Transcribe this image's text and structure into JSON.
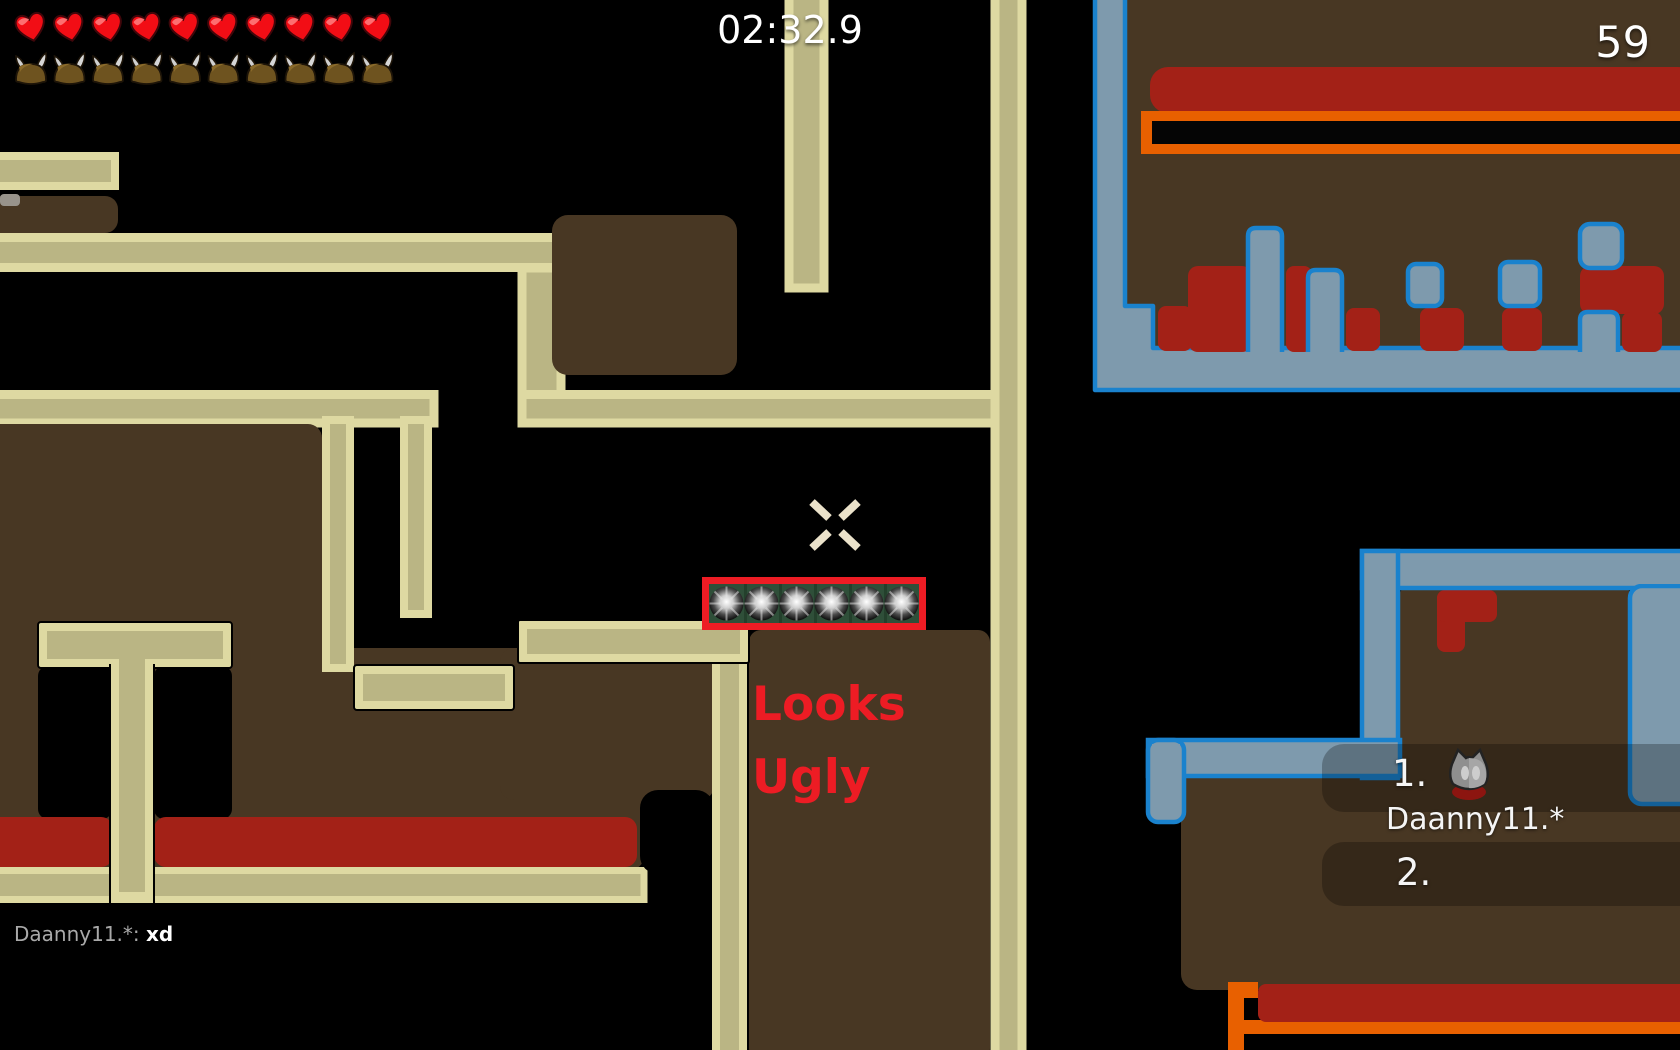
{
  "hud": {
    "timer": "02:32.9",
    "score": "59",
    "hearts": 10,
    "armors": 10
  },
  "chat": {
    "author": "Daanny11.*",
    "separator": ": ",
    "message": "xd"
  },
  "world_text": {
    "line1": "Looks",
    "line2": "Ugly"
  },
  "scoreboard": {
    "first_rank": "1.",
    "first_name": "Daanny11.*",
    "second_rank": "2."
  },
  "colors": {
    "accent_red": "#ed1c24",
    "platform_outline": "#ded9a2",
    "platform_fill": "#bab584",
    "ground_brown": "#483723",
    "danger_red": "#a32117",
    "freeze_outline_blue": "#1a82cd",
    "freeze_fill": "#7e9aad",
    "orange": "#e86000",
    "stopper_green": "#2f4f39"
  }
}
